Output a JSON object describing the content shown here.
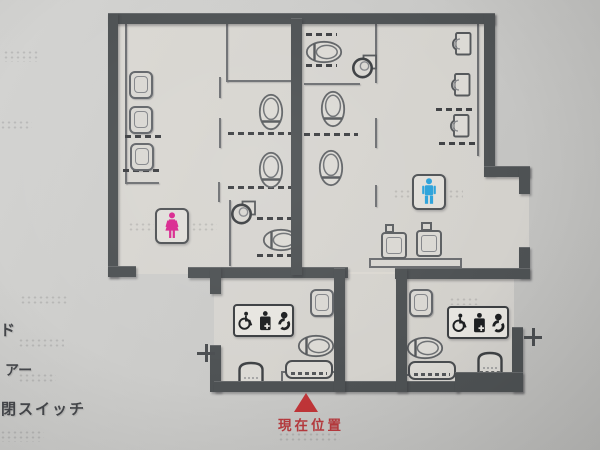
{
  "legend": {
    "items": [
      {
        "label": "ド"
      },
      {
        "label": "アー"
      },
      {
        "label": "開閉スイッチ"
      }
    ]
  },
  "current_location": {
    "marker_glyph": "▲",
    "label": "現在位置"
  },
  "colors": {
    "wall": "#4e5254",
    "partition": "#6e7073",
    "female": "#d9278f",
    "male": "#2ba2da",
    "marker": "#bf2a2d",
    "marker_text": "#b73a3e",
    "icon_black": "#1d1f21",
    "panel_bg": "#e7e5e0",
    "background": "#cbcbc9"
  },
  "icons": {
    "female_room": "woman-icon",
    "male_room": "man-icon",
    "accessible": "wheelchair-icon",
    "ostomate": "ostomate-icon",
    "baby": "baby-icon",
    "door_switch": "plus-switch-icon",
    "cleaning_sink": "mop-sink-icon",
    "location": "triangle-marker-icon"
  }
}
